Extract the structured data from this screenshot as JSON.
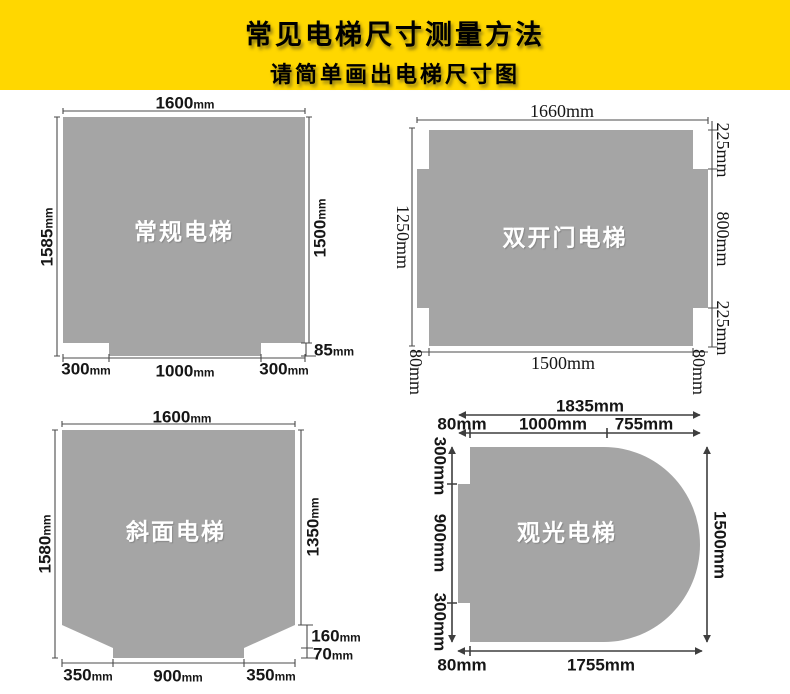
{
  "header": {
    "title": "常见电梯尺寸测量方法",
    "subtitle": "请简单画出电梯尺寸图"
  },
  "colors": {
    "banner_yellow": "#ffd700",
    "shape_gray": "#a5a5a5",
    "line_dark": "#4b4b4b"
  },
  "diagrams": {
    "regular": {
      "label": "常规电梯",
      "dim_top": "1600mm",
      "dim_left": "1585mm",
      "dim_right": "1500mm",
      "dim_step": "85mm",
      "dim_bottom_left": "300mm",
      "dim_bottom_center": "1000mm",
      "dim_bottom_right": "300mm"
    },
    "double_door": {
      "label": "双开门电梯",
      "dim_top": "1660mm",
      "dim_left": "1250mm",
      "dim_right_top": "225mm",
      "dim_right_middle": "800mm",
      "dim_right_bottom": "225mm",
      "dim_bottom_center": "1500mm",
      "dim_bottom_left": "80mm",
      "dim_bottom_right": "80mm"
    },
    "slanted": {
      "label": "斜面电梯",
      "dim_top": "1600mm",
      "dim_left": "1580mm",
      "dim_right": "1350mm",
      "dim_chamfer": "160mm",
      "dim_step": "70mm",
      "dim_bottom_left": "350mm",
      "dim_bottom_center": "900mm",
      "dim_bottom_right": "350mm"
    },
    "observation": {
      "label": "观光电梯",
      "dim_top_total": "1835mm",
      "dim_top_left": "80mm",
      "dim_top_center": "1000mm",
      "dim_top_right": "755mm",
      "dim_left_top": "300mm",
      "dim_left_middle": "900mm",
      "dim_left_bottom": "300mm",
      "dim_right": "1500mm",
      "dim_bottom_left": "80mm",
      "dim_bottom": "1755mm"
    }
  }
}
